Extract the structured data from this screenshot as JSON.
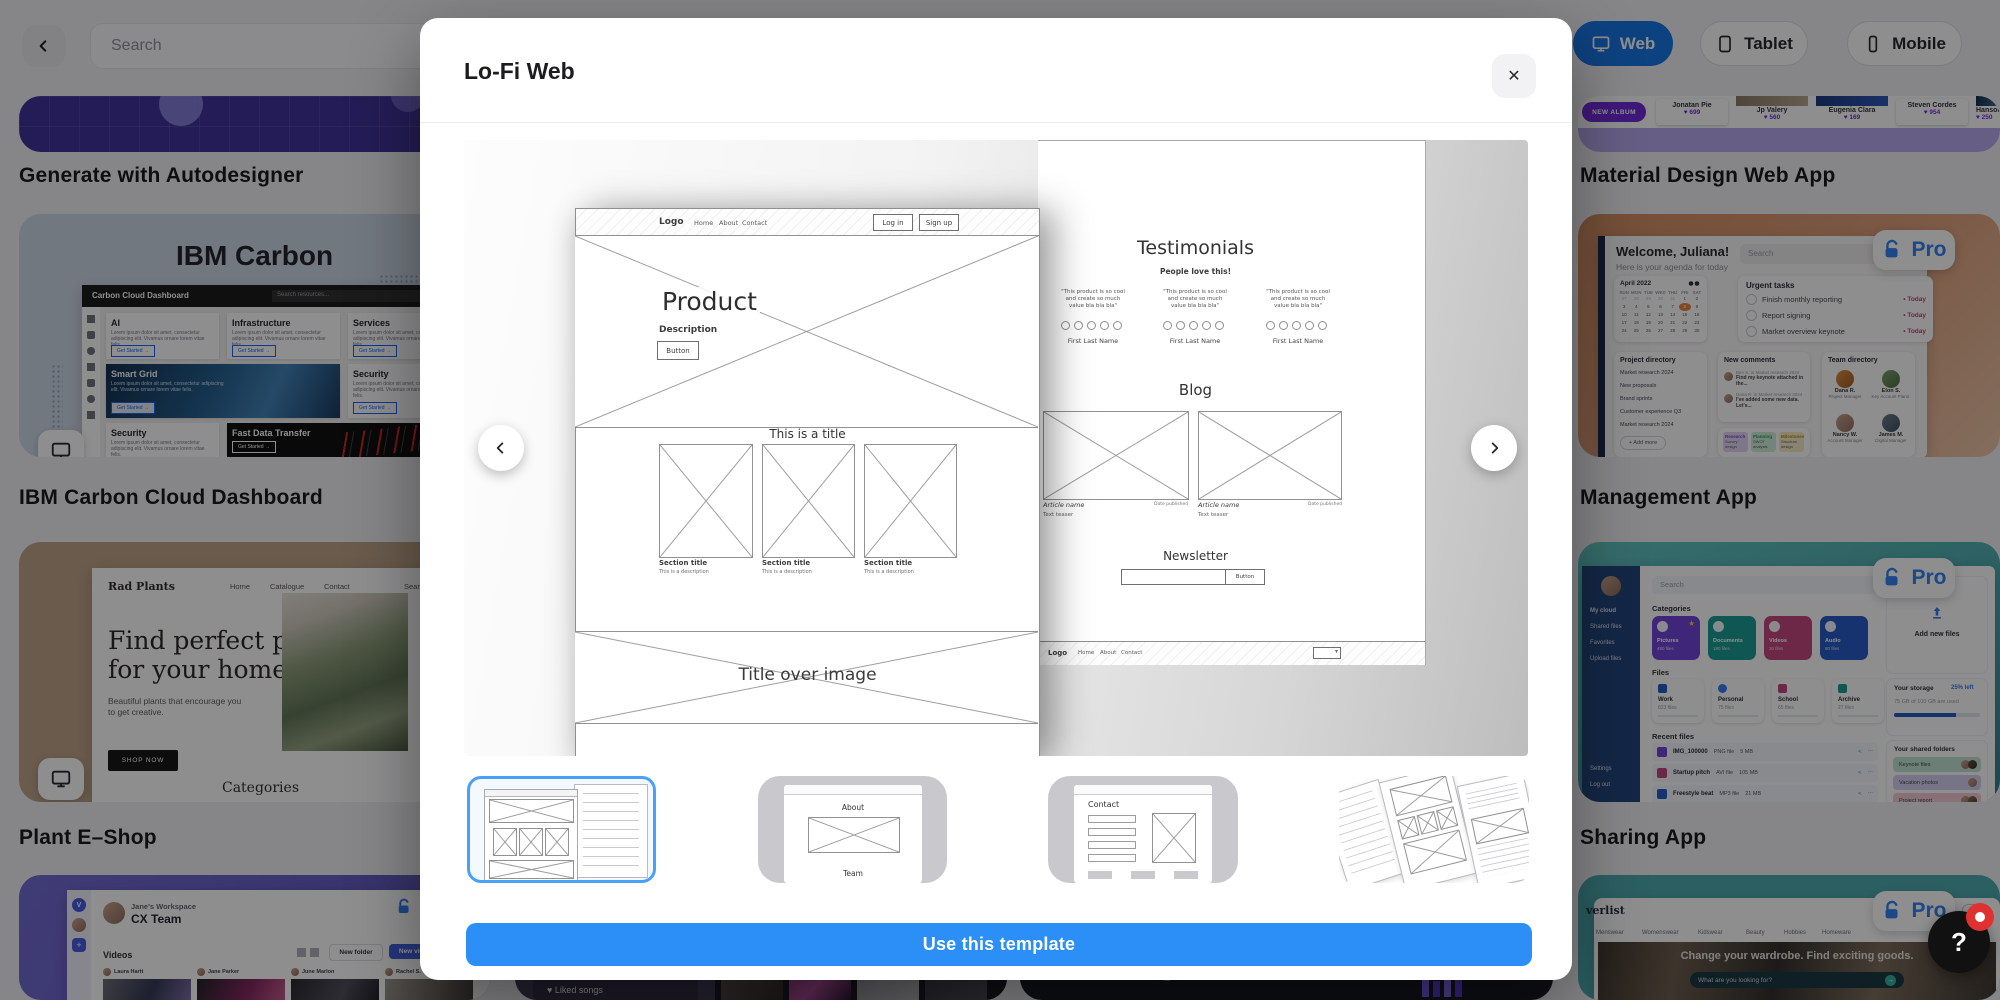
{
  "topbar": {
    "search_placeholder": "Search",
    "devices": {
      "web": "Web",
      "tablet": "Tablet",
      "mobile": "Mobile"
    }
  },
  "modal": {
    "title": "Lo-Fi Web",
    "cta": "Use this template",
    "thumbs": {
      "about": "About",
      "team": "Team",
      "contact": "Contact"
    }
  },
  "wire1": {
    "logo": "Logo",
    "nav": [
      "Home",
      "About",
      "Contact"
    ],
    "login": "Log in",
    "signup": "Sign up",
    "hero_title": "Product",
    "hero_desc": "Description",
    "hero_button": "Button",
    "section_heading": "This is a title",
    "card_title": "Section title",
    "card_desc": "This is a description",
    "banner": "Title over image"
  },
  "wire2": {
    "t_title": "Testimonials",
    "t_sub": "People love this!",
    "quote": "\"This product is so cool and create so much value bla bla bla\"",
    "person": "First Last Name",
    "blog_title": "Blog",
    "article_name": "Article name",
    "article_date": "Date published",
    "article_teaser": "Text teaser",
    "n_title": "Newsletter",
    "n_button": "Button",
    "f_logo": "Logo"
  },
  "gallery": {
    "left": {
      "autodesigner_label": "Generate with Autodesigner",
      "ibm": {
        "title": "IBM Carbon",
        "label": "IBM Carbon Cloud Dashboard",
        "appbar": "Carbon Cloud Dashboard",
        "search": "Search resources...",
        "lorem": "Lorem ipsum dolor sit amet, consectetur adipiscing elit. Vivamus ornare lorem vitae felis.",
        "cta": "Get Started",
        "tiles": [
          "AI",
          "Infrastructure",
          "Services",
          "Smart Grid",
          "Security",
          "Fast Data Transfer"
        ]
      },
      "plant": {
        "label": "Plant E–Shop",
        "logo": "Rad Plants",
        "nav": [
          "Home",
          "Catalogue",
          "Contact"
        ],
        "nav_right": [
          "Search",
          "Cart (0)"
        ],
        "headline_1": "Find perfect plants",
        "headline_2": "for your home",
        "sub": "Beautiful plants that encourage you to get creative.",
        "button": "SHOP NOW",
        "categories": "Categories"
      },
      "cx": {
        "workspace": "Jane's Workspace",
        "team": "CX Team",
        "videos": "Videos",
        "new_folder": "New folder",
        "new_video": "New video",
        "authors": [
          "Laura Hartt",
          "Jane Parker",
          "June Marlon",
          "Rachel S."
        ]
      }
    },
    "right": {
      "material": {
        "label": "Material Design Web App",
        "album_button": "NEW ALBUM",
        "artists": [
          {
            "name": "Jonatan Pie",
            "likes": "699"
          },
          {
            "name": "Jp Valery",
            "likes": "560"
          },
          {
            "name": "Eugenia Clara",
            "likes": "169"
          },
          {
            "name": "Steven Cordes",
            "likes": "954"
          },
          {
            "name": "Hanson Lu",
            "likes": "250"
          }
        ]
      },
      "management": {
        "label": "Management App",
        "pro": "Pro",
        "welcome": "Welcome, Juliana!",
        "agenda": "Here is your agenda for today",
        "search": "Search",
        "calendar_title": "April 2022",
        "day_headers": [
          "SUN",
          "MON",
          "TUE",
          "WED",
          "THU",
          "FRI",
          "SAT"
        ],
        "calendar_cells": [
          "27",
          "28",
          "29",
          "30",
          "31",
          "1",
          "2",
          "3",
          "4",
          "5",
          "6",
          "7",
          "8",
          "9",
          "10",
          "11",
          "12",
          "13",
          "14",
          "15",
          "16",
          "17",
          "18",
          "19",
          "20",
          "21",
          "22",
          "23",
          "24",
          "25",
          "26",
          "27",
          "28",
          "29",
          "30"
        ],
        "highlight_day": "8",
        "urgent_title": "Urgent tasks",
        "tasks": [
          "Finish monthly reporting",
          "Report signing",
          "Market overview keynote"
        ],
        "task_badge": "• Today",
        "projects_title": "Project directory",
        "projects": [
          "Market research 2024",
          "New proposals",
          "Brand sprints",
          "Customer experience Q3",
          "Market research 2024"
        ],
        "add_more": "+ Add more",
        "comments_title": "New comments",
        "comments": [
          {
            "meta": "Ben S. in Market research 2024",
            "text": "Find my keynote attached in the..."
          },
          {
            "meta": "Dana R. in Market research 2024",
            "text": "I've added some new data. Let's..."
          }
        ],
        "tags": [
          {
            "name": "Research",
            "sub": "Survey design"
          },
          {
            "name": "Planning",
            "sub": "SWOT analysis"
          },
          {
            "name": "Milestones",
            "sub": "Structure design"
          }
        ],
        "team_title": "Team directory",
        "members": [
          {
            "name": "Dana R.",
            "role": "Project Manager"
          },
          {
            "name": "Elon S.",
            "role": "Key Account Plann."
          },
          {
            "name": "Nancy W.",
            "role": "Account Manager"
          },
          {
            "name": "James M.",
            "role": "Digital Manager"
          }
        ]
      },
      "sharing": {
        "label": "Sharing App",
        "pro": "Pro",
        "search": "Search",
        "side": [
          "My cloud",
          "Shared files",
          "Favorites",
          "Upload files",
          "Settings",
          "Log out"
        ],
        "categories_title": "Categories",
        "categories": [
          {
            "name": "Pictures",
            "count": "480 files"
          },
          {
            "name": "Documents",
            "count": "190 files"
          },
          {
            "name": "Videos",
            "count": "30 files"
          },
          {
            "name": "Audio",
            "count": "80 files"
          }
        ],
        "files_title": "Files",
        "folders": [
          {
            "name": "Work",
            "count": "823 files"
          },
          {
            "name": "Personal",
            "count": "75 files"
          },
          {
            "name": "School",
            "count": "65 files"
          },
          {
            "name": "Archive",
            "count": "27 files"
          }
        ],
        "recent_title": "Recent files",
        "recent": [
          {
            "name": "IMG_100000",
            "type": "PNG file",
            "size": "5 MB"
          },
          {
            "name": "Startup pitch",
            "type": "AVI file",
            "size": "105 MB"
          },
          {
            "name": "Freestyle beat",
            "type": "MP3 file",
            "size": "21 MB"
          },
          {
            "name": "Work proposal",
            "type": "DOCx file",
            "size": "500 kb"
          }
        ],
        "add_new": "Add new files",
        "storage_title": "Your storage",
        "storage_left": "25% left",
        "storage_sub": "75 GB of 100 GB are used",
        "shared_title": "Your shared folders",
        "shared": [
          "Keynote files",
          "Vacation photos",
          "Project report"
        ],
        "add_more": "+ add more"
      },
      "wardrobe": {
        "pro": "Pro",
        "logo": "verlist",
        "nav": [
          "Menswear",
          "Womenswear",
          "Kidswear",
          "Beauty",
          "Hobbies",
          "Homeware"
        ],
        "hero": "Change your wardrobe. Find exciting goods.",
        "search": "What are you looking for?"
      }
    },
    "bottom": {
      "music": [
        "New playlist",
        "Liked songs"
      ],
      "stat": "10,140",
      "product_list": "Product list"
    }
  },
  "help": {
    "label": "?"
  },
  "icons": {
    "heart": "♥",
    "close": "✕",
    "star": "★",
    "plus": "+",
    "share": "<",
    "ellipsis": "⋯",
    "arrow_right": "→",
    "caret": "▾",
    "dot": "•"
  },
  "colors": {
    "accent_blue": "#2B8FF7",
    "selected_thumb_border": "#47A1F8",
    "web_pill_blue": "#1273E6",
    "pro_blue": "#2D7FF0",
    "highlight_orange": "#E8833A"
  }
}
